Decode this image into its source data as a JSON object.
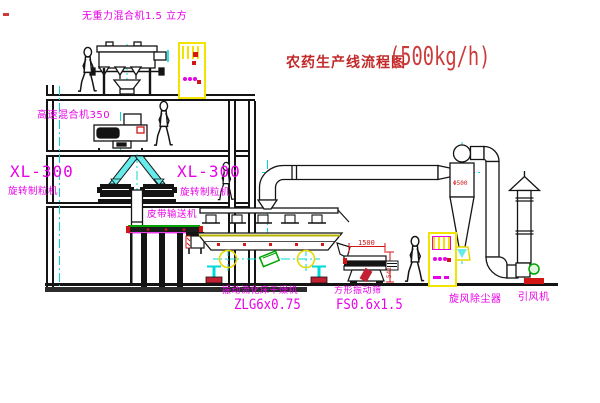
{
  "title": {
    "text": "农药生产线流程图",
    "capacity": "(500kg/h)"
  },
  "labels": {
    "gravity_free_mixer": "无重力混合机1.5 立方",
    "high_speed_mixer": "高速混合机350",
    "granulator_left": {
      "model": "XL-300",
      "name": "旋转制粒机"
    },
    "granulator_mid": {
      "model": "XL-300",
      "name": "旋转制粒机"
    },
    "belt_conveyor": "皮带输送机",
    "fluid_bed_dryer": {
      "name": "振动流化床干燥机",
      "model": "ZLG6x0.75"
    },
    "square_sieve": {
      "name": "方形振动筛",
      "model": "FS0.6x1.5"
    },
    "cyclone": "旋风除尘器",
    "induced_draft_fan": "引风机"
  },
  "dimensions": {
    "sieve_length": "1500",
    "cyclone_diameter": "Φ500",
    "sieve_height": "541"
  },
  "colors": {
    "label_magenta": "#e800e8",
    "title_red": "#c22a2a",
    "centerline_cyan": "#00d8d8",
    "cabinet_yellow": "#f2e400",
    "accent_red": "#d21616",
    "accent_green": "#00a400",
    "line_black": "#141414"
  }
}
